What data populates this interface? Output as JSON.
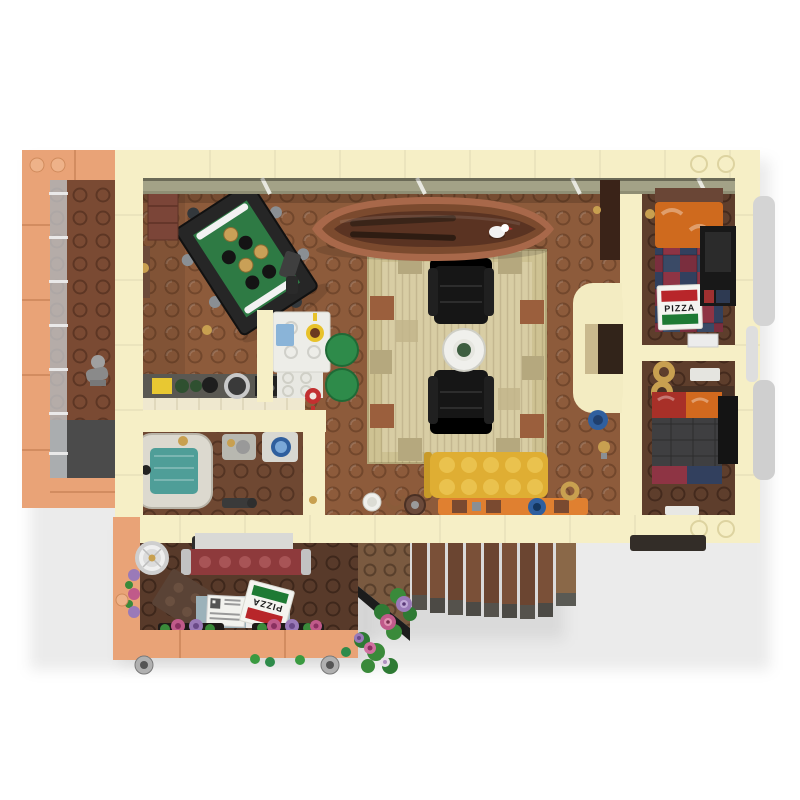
{
  "meta": {
    "description": "Top-down studio render of a LEGO-style apartment interior (MOC floor plan) on a white background",
    "view": "overhead floor plan"
  },
  "labels": {
    "pizza_box_bedroom": "PIZZA",
    "pizza_box_shop": "PIZZA"
  },
  "palette": {
    "background": "#ffffff",
    "wall_cream": "#f6efc6",
    "wall_salmon": "#e9a377",
    "floor_living": "#8d5b3b",
    "floor_balcony": "#7a4a33",
    "floor_bathroom": "#6f4832",
    "floor_bedroom": "#5e3e2c",
    "floor_shop": "#583a2a",
    "rug_tan": "#cec293",
    "sofa_yellow": "#e2b33c",
    "bench_orange": "#e08030",
    "pool_felt_green": "#2e7a44",
    "canoe_brown": "#a8684a",
    "bed_maroon": "#8e3a3c",
    "pillow_orange": "#cf6a1e",
    "plaid_navy": "#32405e",
    "plaid_red": "#8e3444",
    "stool_green": "#2e8b4a",
    "bath_water_teal": "#4f9e98",
    "glass_gray": "#c9cdd0",
    "stairs_wood": "#6b4531"
  },
  "rooms": [
    {
      "name": "balcony",
      "items": [
        "glass-railing",
        "stone-statue",
        "dark-floor-mat"
      ]
    },
    {
      "name": "living-room",
      "items": [
        "canoe-with-seagull-and-paddles",
        "pool-table-with-balls",
        "patchwork-rug",
        "black-armchair",
        "black-armchair",
        "round-table-with-plate",
        "yellow-sofa",
        "orange-bench",
        "wall-cabinet",
        "coat-rack"
      ]
    },
    {
      "name": "kitchen",
      "items": [
        "white-dining-table",
        "blue-carton",
        "yellow-mug",
        "red-mug",
        "green-stool",
        "green-stool",
        "stove-counter",
        "pans-and-bottles"
      ]
    },
    {
      "name": "bathroom",
      "items": [
        "bathtub-with-water",
        "gold-tap",
        "sink",
        "washing-machine",
        "floor-pipes"
      ]
    },
    {
      "name": "bedroom-top-right",
      "items": [
        "bed-with-orange-pillow-and-plaid-blanket",
        "pizza-box",
        "dark-dresser-tv"
      ]
    },
    {
      "name": "hallway-nook",
      "items": [
        "croissant",
        "croissant",
        "white-tray",
        "wall-box"
      ]
    },
    {
      "name": "bedroom-bottom-right",
      "items": [
        "bed-with-red-orange-pillows-and-gray-blanket",
        "dark-wardrobe",
        "white-tray"
      ]
    },
    {
      "name": "flower-shop-cart",
      "items": [
        "round-silver-lamp",
        "maroon-bench",
        "white-sheet",
        "tilted-brown-box",
        "shipping-crate-with-label",
        "tilted-pizza-box",
        "flower-planters",
        "caster-wheels"
      ]
    },
    {
      "name": "staircase",
      "items": [
        "wood-steps",
        "landing-block",
        "flower-cluster",
        "flower-cluster"
      ]
    }
  ]
}
